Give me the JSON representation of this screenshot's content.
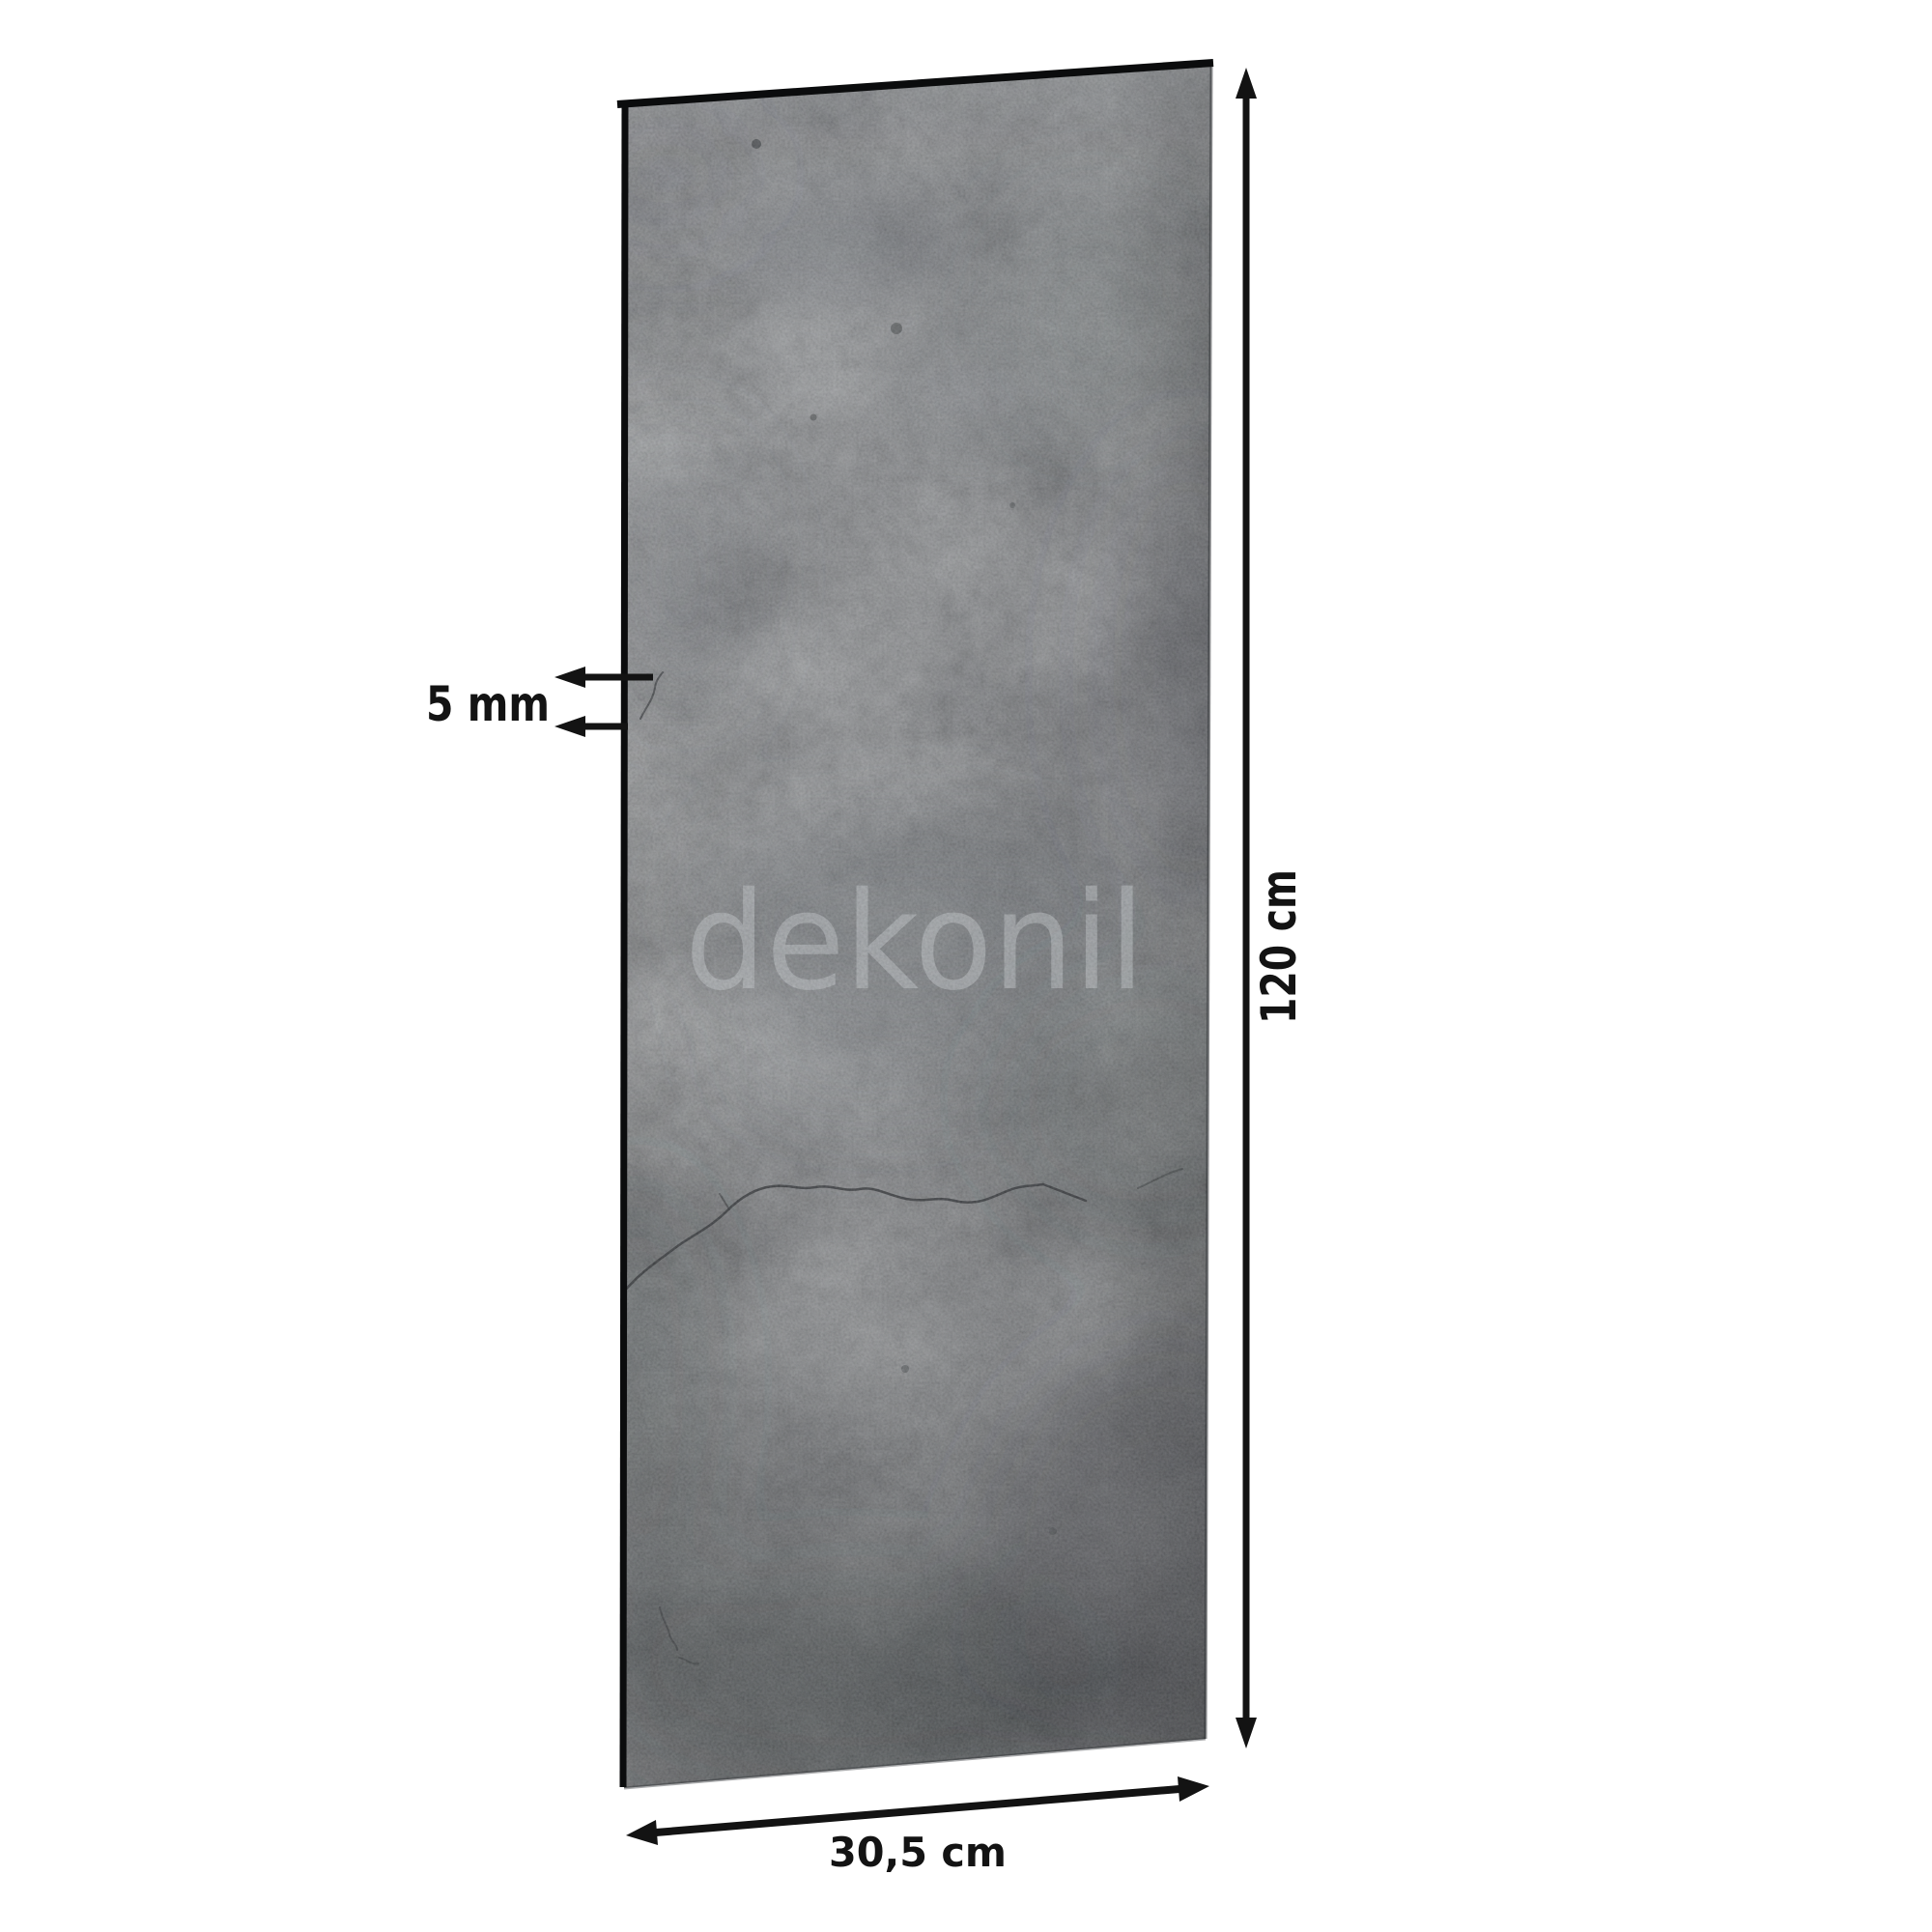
{
  "page": {
    "background_color": "#ffffff"
  },
  "panel": {
    "surface_base_color": "#54585b",
    "edge_color": "#0b0c0d",
    "watermark_text": "dekonil",
    "watermark_color": "#9ba0a3"
  },
  "dimensions": {
    "thickness_label": "5 mm",
    "height_label": "120 cm",
    "width_label": "30,5 cm"
  },
  "annotation": {
    "color": "#131313"
  }
}
